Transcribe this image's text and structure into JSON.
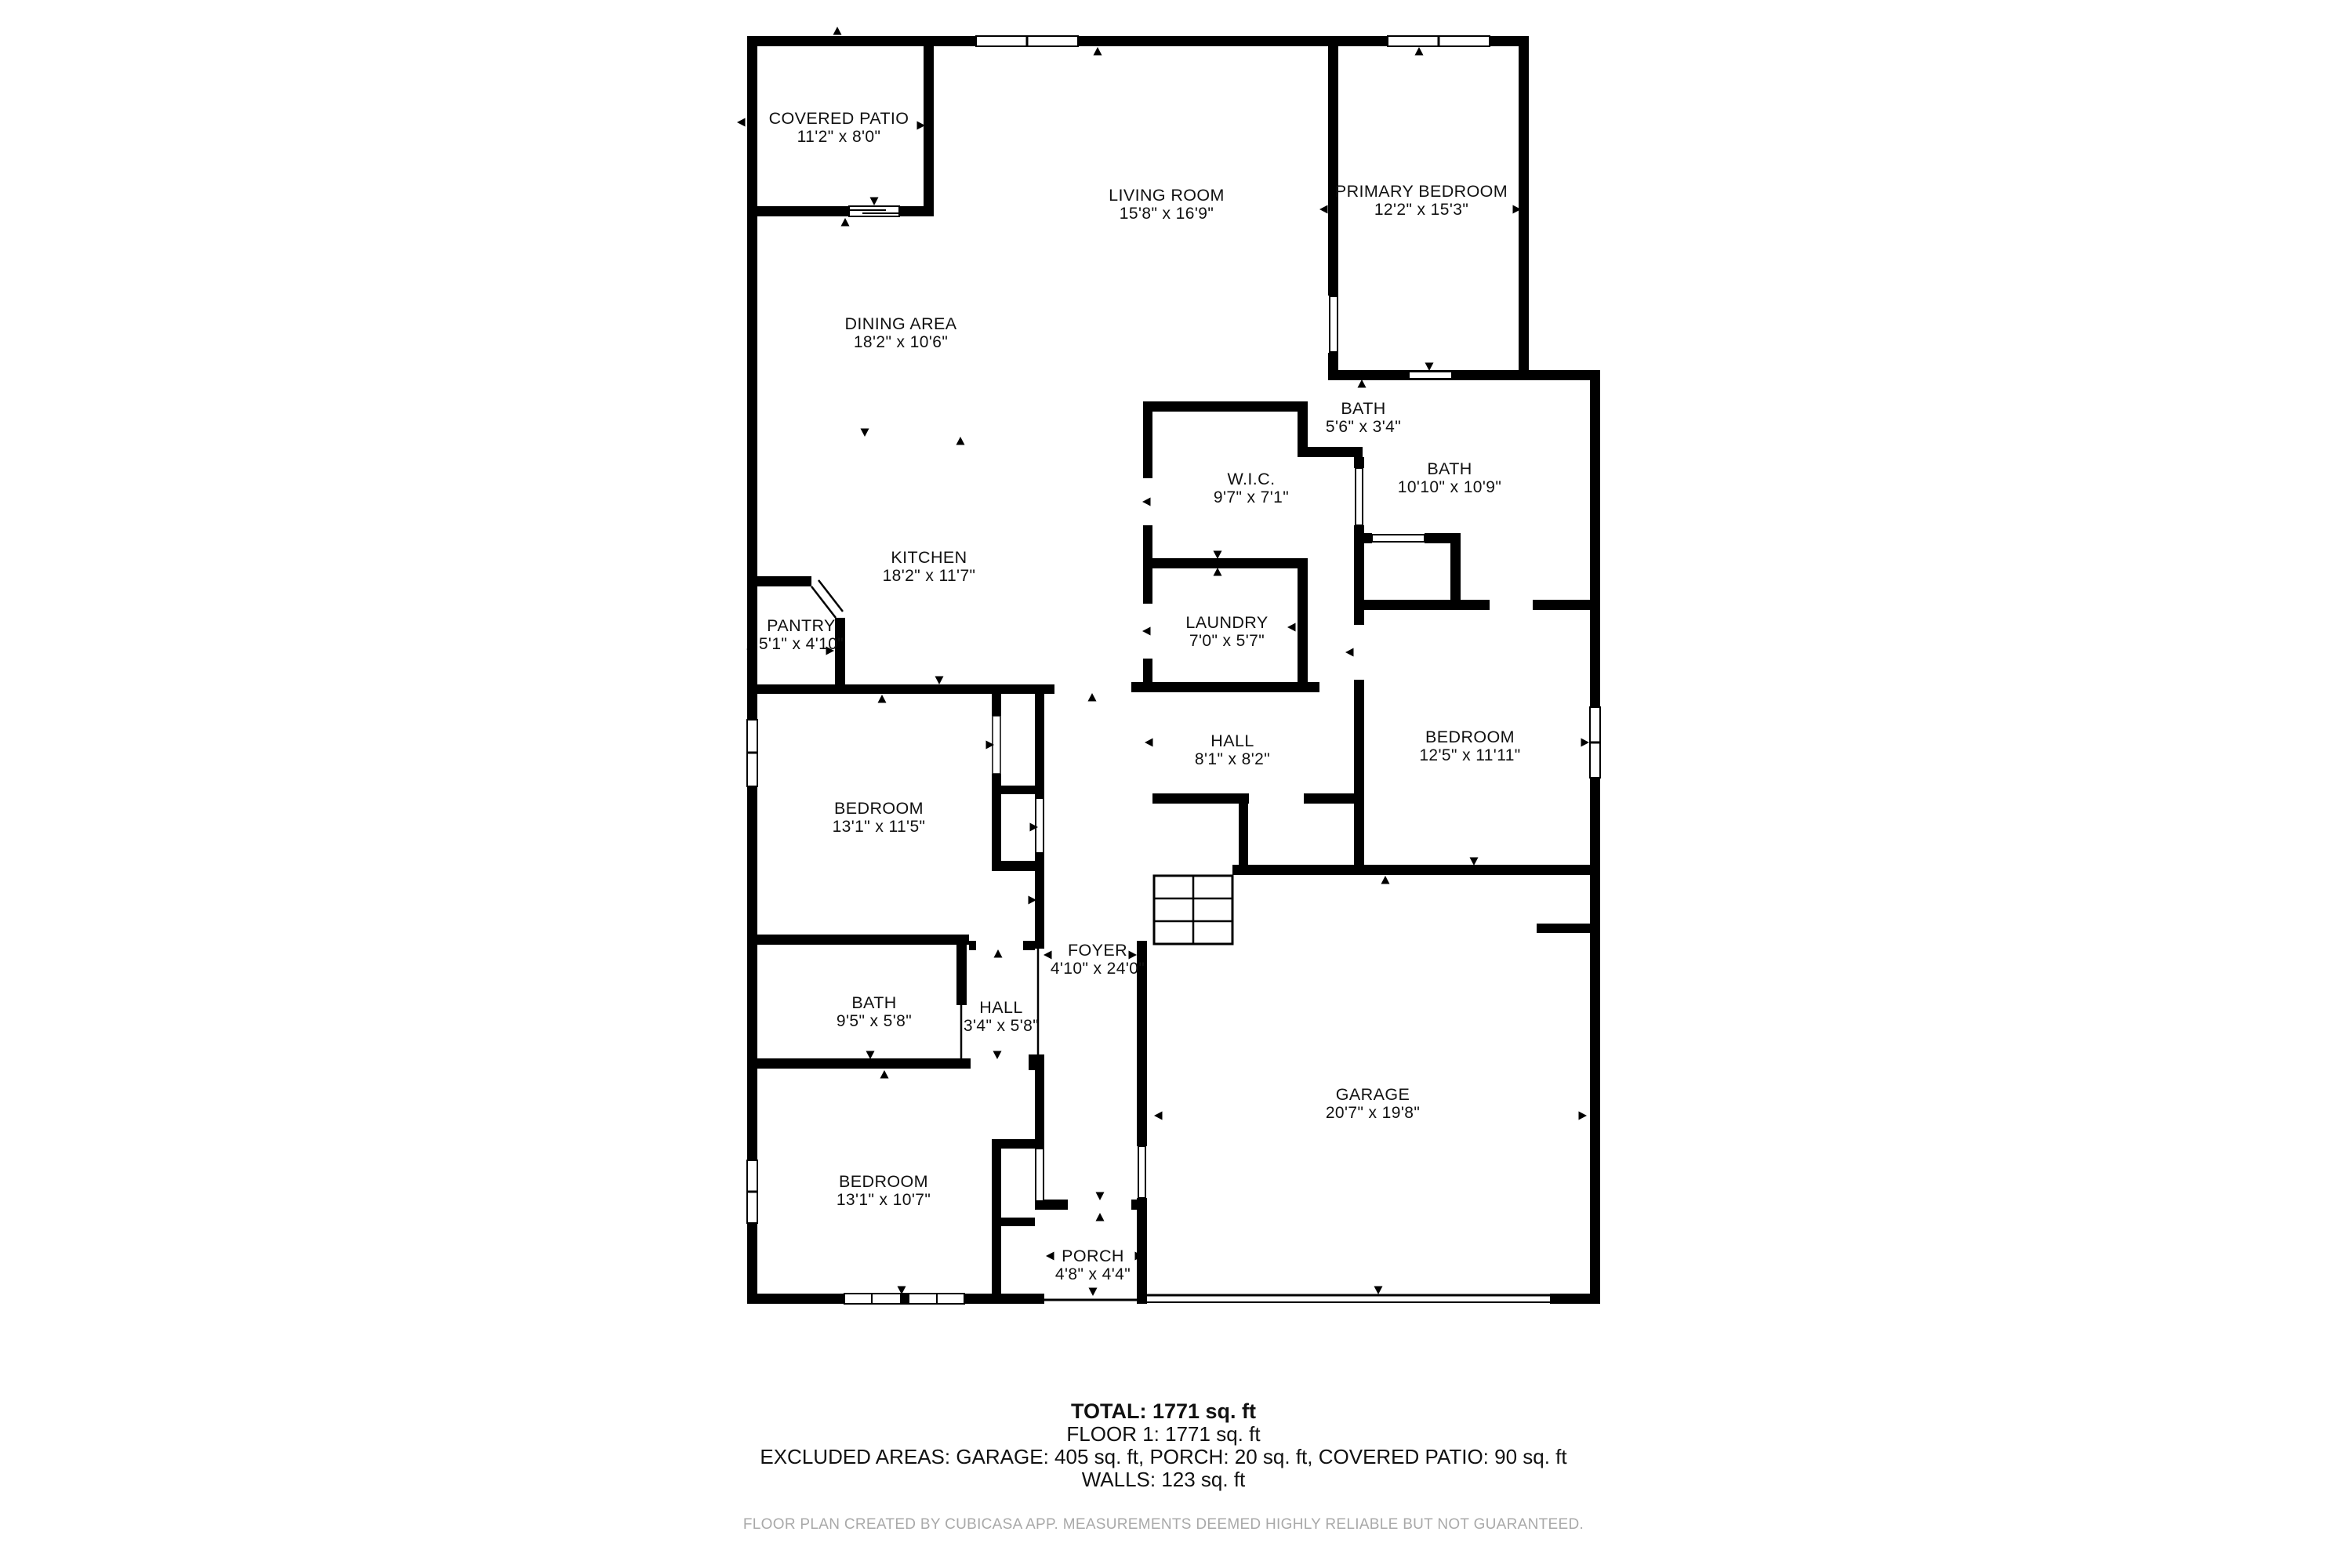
{
  "floor_plan": {
    "rooms": [
      {
        "name": "COVERED PATIO",
        "dims": "11'2\" x 8'0\""
      },
      {
        "name": "LIVING ROOM",
        "dims": "15'8\" x 16'9\""
      },
      {
        "name": "PRIMARY BEDROOM",
        "dims": "12'2\" x 15'3\""
      },
      {
        "name": "DINING AREA",
        "dims": "18'2\" x 10'6\""
      },
      {
        "name": "BATH",
        "dims": "5'6\" x 3'4\""
      },
      {
        "name": "W.I.C.",
        "dims": "9'7\" x 7'1\""
      },
      {
        "name": "BATH",
        "dims": "10'10\" x 10'9\""
      },
      {
        "name": "KITCHEN",
        "dims": "18'2\" x 11'7\""
      },
      {
        "name": "PANTRY",
        "dims": "5'1\" x 4'10\""
      },
      {
        "name": "LAUNDRY",
        "dims": "7'0\" x 5'7\""
      },
      {
        "name": "HALL",
        "dims": "8'1\" x 8'2\""
      },
      {
        "name": "BEDROOM",
        "dims": "12'5\" x 11'11\""
      },
      {
        "name": "BEDROOM",
        "dims": "13'1\" x 11'5\""
      },
      {
        "name": "FOYER",
        "dims": "4'10\" x 24'0\""
      },
      {
        "name": "BATH",
        "dims": "9'5\" x 5'8\""
      },
      {
        "name": "HALL",
        "dims": "3'4\" x 5'8\""
      },
      {
        "name": "BEDROOM",
        "dims": "13'1\" x 10'7\""
      },
      {
        "name": "GARAGE",
        "dims": "20'7\" x 19'8\""
      },
      {
        "name": "PORCH",
        "dims": "4'8\" x 4'4\""
      }
    ],
    "summary": {
      "total": "TOTAL: 1771 sq. ft",
      "floor1": "FLOOR 1: 1771 sq. ft",
      "excluded": "EXCLUDED AREAS: GARAGE: 405 sq. ft, PORCH: 20 sq. ft, COVERED PATIO: 90 sq. ft",
      "walls": "WALLS: 123 sq. ft"
    },
    "footer": "FLOOR PLAN CREATED BY CUBICASA APP. MEASUREMENTS DEEMED HIGHLY RELIABLE BUT NOT GUARANTEED.",
    "colors": {
      "wall": "#000000",
      "background": "#ffffff",
      "footer_text": "#a9a9a9"
    }
  }
}
